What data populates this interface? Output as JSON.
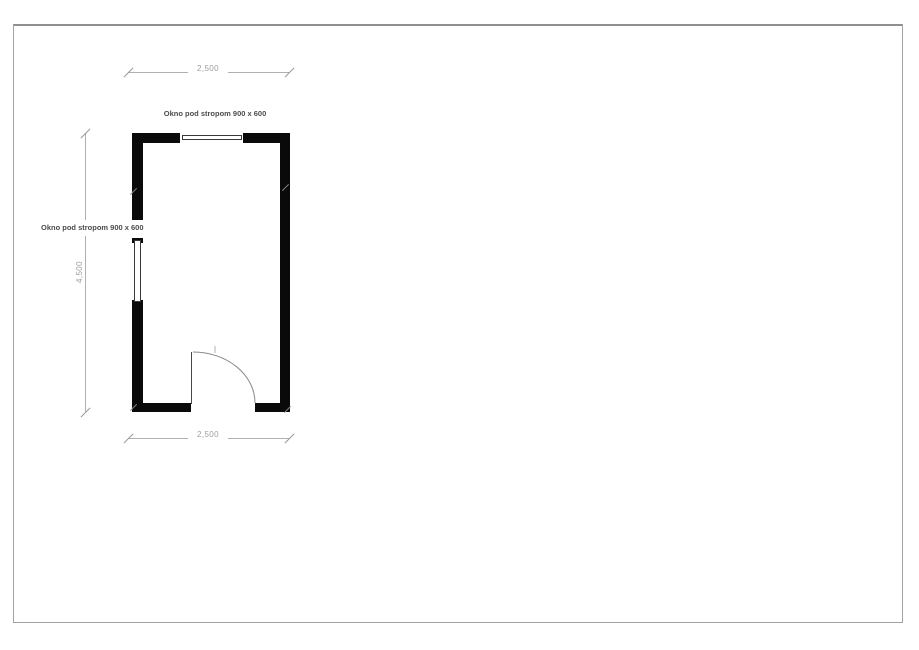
{
  "document": {
    "kind": "floor-plan-drawing",
    "page_border_color": "#9a9a9a"
  },
  "plan": {
    "dimensions": {
      "top": "2,500",
      "bottom": "2,500",
      "left": "4,500"
    },
    "labels": {
      "top_window": "Okno pod stropom 900 x 600",
      "left_window": "Okno pod stropom 900 x 600"
    },
    "colors": {
      "wall": "#0a0a0a",
      "dimension": "#a0a0a0",
      "label_text": "#4c4c4c",
      "door_arc": "#8a8a8a"
    }
  }
}
